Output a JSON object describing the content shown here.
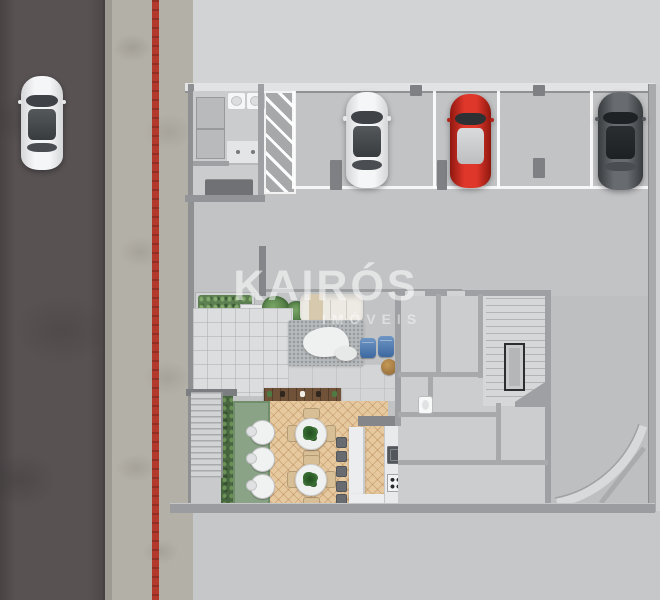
{
  "watermark": {
    "brand": "KAIRÓS",
    "tagline": "IMÓVEIS"
  },
  "scene": {
    "type": "architectural-floor-plan-render",
    "view": "top-down",
    "street": {
      "lanes": 1,
      "cars": [
        {
          "color": "white",
          "state": "driving"
        }
      ]
    },
    "sidewalk": {
      "tactile_line": true
    },
    "garage": {
      "no_parking_hatch": true,
      "parking_spaces": 4,
      "parked_cars": [
        {
          "color": "white"
        },
        {
          "color": "red"
        },
        {
          "color": "dark-gray"
        }
      ],
      "restroom": {
        "toilets": 2,
        "sinks": 2
      }
    },
    "lobby": {
      "features": [
        "planter hedge",
        "potted plants",
        "cream sofa",
        "lounge rug",
        "white lounge seats",
        "blue armchairs",
        "rattan pouf",
        "wood sideboard"
      ]
    },
    "cafe": {
      "floor": "herringbone wood",
      "dining_tables": 2,
      "garden_tables": 3,
      "bar_stools": 5,
      "kitchen": [
        "bar counter",
        "sink",
        "cooktop"
      ]
    },
    "core": {
      "stairwell": true,
      "elevator_core": true,
      "rooms": 5,
      "curved_ramp": true
    }
  },
  "colors": {
    "road": "#585253",
    "sidewalk": "#b3b0a7",
    "red_line": "#b2392c",
    "plaza": "#d2d3d5",
    "garage_floor": "#c2c3c5",
    "wall": "#9ea0a3",
    "rug": "#b7babc",
    "wood_floor": "#e7c99f",
    "wood_dark": "#6f5238",
    "deck": "#8aa286",
    "hedge": "#47653f",
    "blue_chair": "#3d69a1",
    "chair_tan": "#d9bf96",
    "stool": "#686b6f",
    "car_red": "#df372a",
    "car_dark": "#686c70",
    "watermark": "#ffffff"
  }
}
